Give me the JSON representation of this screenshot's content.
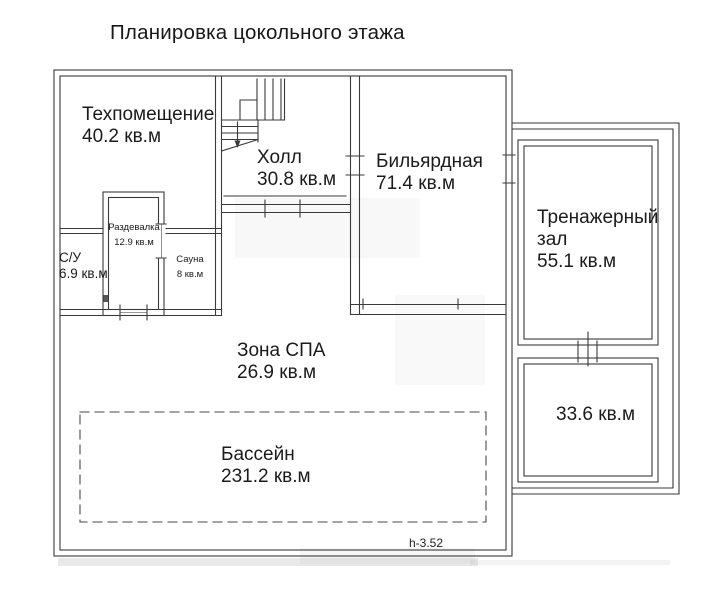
{
  "title": "Планировка цокольного этажа",
  "floor_plan": {
    "rooms": [
      {
        "name": "Техпомещение",
        "area": "40.2 кв.м"
      },
      {
        "name": "Холл",
        "area": "30.8 кв.м"
      },
      {
        "name": "Бильярдная",
        "area": "71.4 кв.м"
      },
      {
        "name": "Тренажерный зал",
        "area": "55.1 кв.м"
      },
      {
        "name": "Раздевалка",
        "area": "12.9 кв.м"
      },
      {
        "name": "С/У",
        "area": "6.9 кв.м"
      },
      {
        "name": "Сауна",
        "area": "8 кв.м"
      },
      {
        "name": "Зона СПА",
        "area": "26.9 кв.м"
      },
      {
        "name": "Бассейн",
        "area": "231.2 кв.м"
      },
      {
        "name": "",
        "area": "33.6 кв.м"
      }
    ],
    "height_note": "h-3.52"
  },
  "colors": {
    "line": "#3a3a3a",
    "text": "#1b1b1b",
    "background": "#ffffff"
  }
}
